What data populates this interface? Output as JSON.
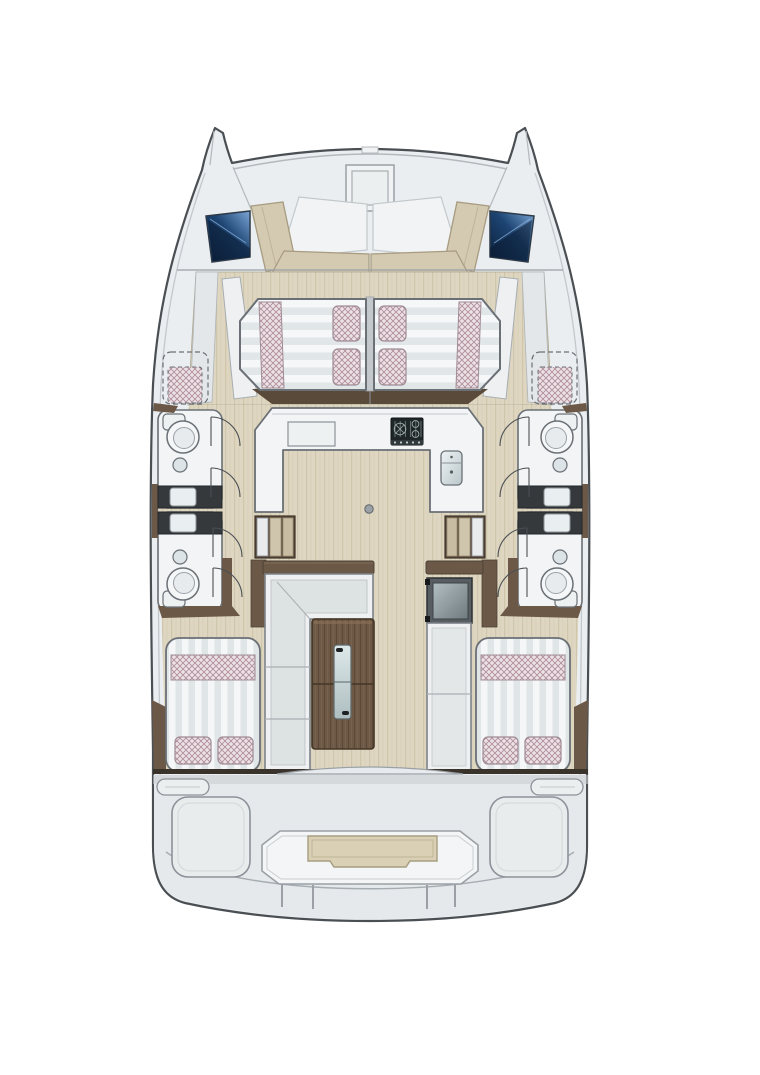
{
  "diagram": {
    "kind": "catamaran-floor-plan",
    "view": "top-down",
    "rooms": {
      "bow": "foredeck-lounge",
      "forward": "double-berths",
      "center": "galley",
      "port_hull": "two-bathrooms",
      "starboard_hull": "two-bathrooms",
      "midship": "saloon-sofa-table",
      "aft": "two-double-cabins",
      "stern": "cockpit-platform"
    }
  },
  "colors": {
    "page": "#ffffff",
    "deck": "#ebeef0",
    "deck_aft": "#e6e9eb",
    "outline": "#4a4f54",
    "outline_soft": "#8b9299",
    "counter": "#f2f4f5",
    "fabric_white": "#eef0f1",
    "beige": "#d3cab1",
    "beige_edge": "#a79b80",
    "floor_wood": "#ded6c0",
    "wood_dark": "#6b5847",
    "wood_table": "#6e5946",
    "vanity": "#35393c",
    "stove": "#1f2628",
    "checker_base": "#ece2e6",
    "checker_line": "#b08f9c",
    "mattress_stripe": "#e1e6e8",
    "window_deep": "#0a1f3a",
    "window_light": "#7aa6d6",
    "glass": "#c3d2d4"
  }
}
